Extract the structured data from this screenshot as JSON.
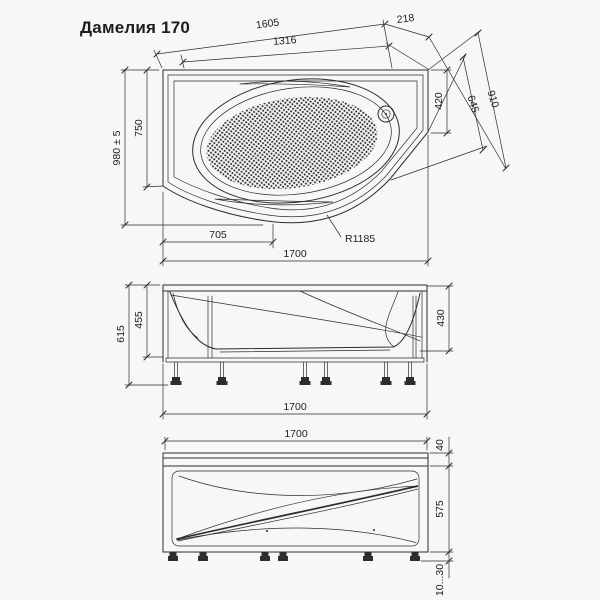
{
  "title": "Дамелия 170",
  "colors": {
    "line": "#2d2d2d",
    "text": "#1d1d1f",
    "background": "#f7f7f8"
  },
  "top_view": {
    "diag_top": "1605",
    "diag_inner": "1316",
    "diag_corner": "218",
    "overall_width": "980 ± 5",
    "left_straight": "750",
    "right_edge": "420",
    "slant_inner": "645",
    "slant_outer": "910",
    "bottom_offset": "705",
    "corner_radius": "R1185",
    "overall_length": "1700"
  },
  "side_view": {
    "total_height": "615",
    "frame_height": "455",
    "right_depth": "430",
    "length": "1700"
  },
  "front_view": {
    "length": "1700",
    "rim_height": "40",
    "panel_height": "575",
    "feet_adjust": "10...30"
  }
}
